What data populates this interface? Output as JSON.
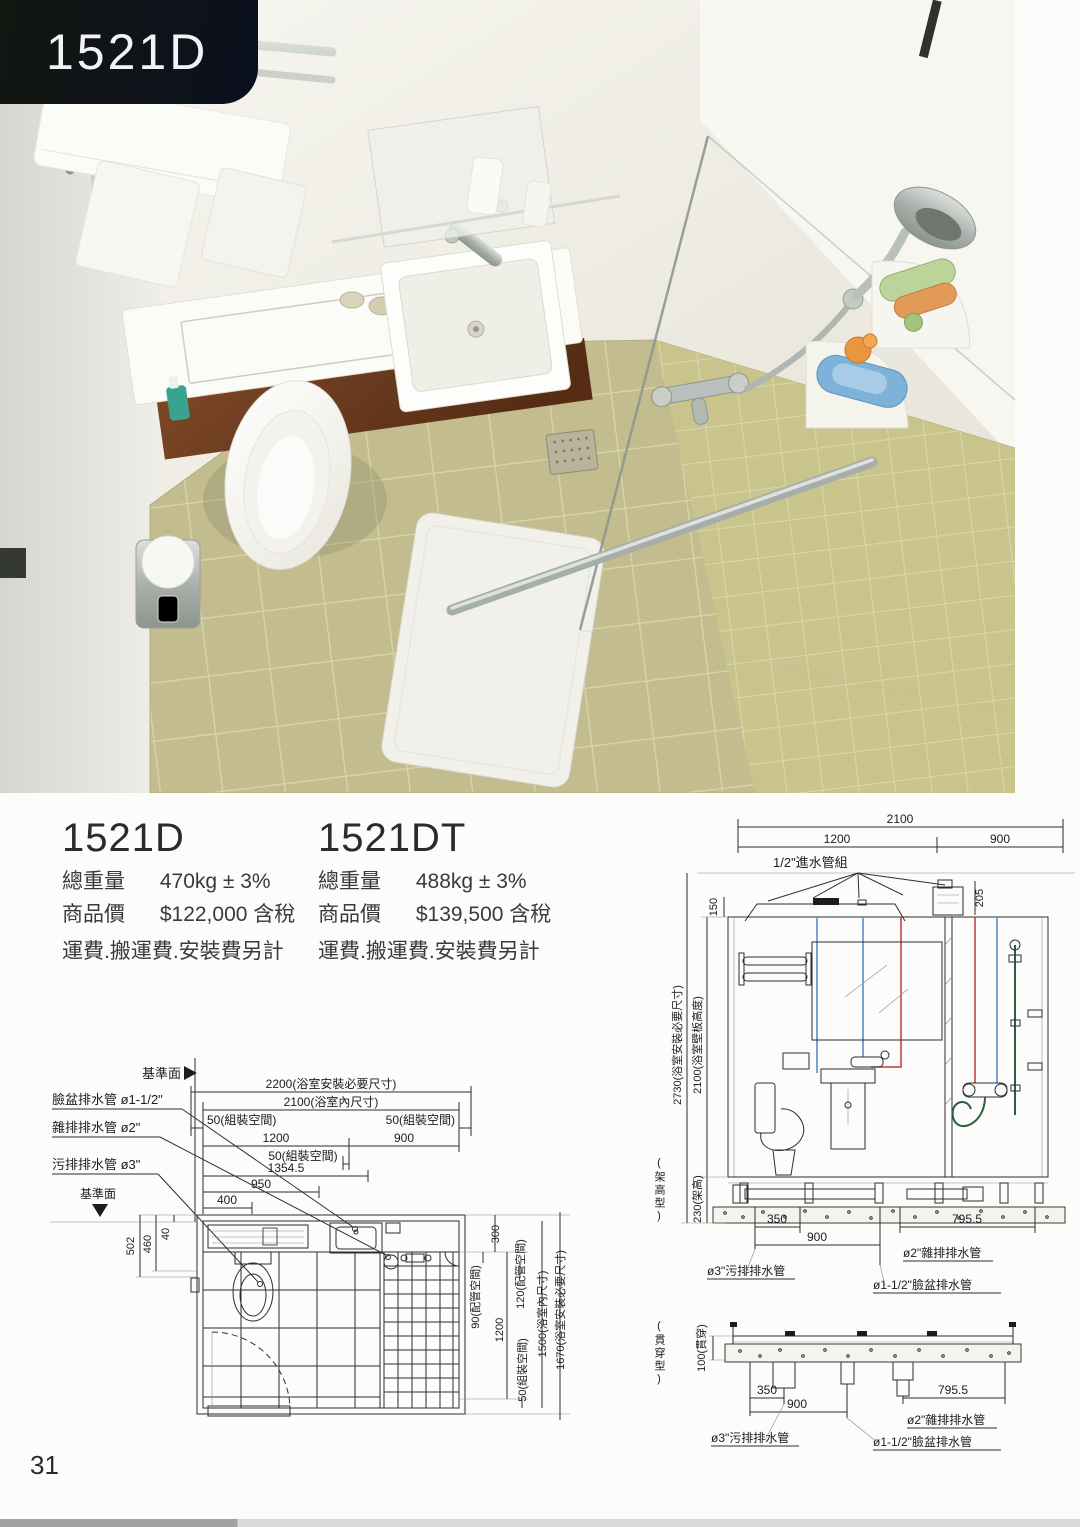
{
  "page": {
    "badge": "1521D",
    "page_number": "31"
  },
  "products": [
    {
      "model": "1521D",
      "weight_label": "總重量",
      "weight_value": "470kg ± 3%",
      "price_label": "商品價",
      "price_value": "$122,000 含稅",
      "note": "運費.搬運費.安裝費另計"
    },
    {
      "model": "1521DT",
      "weight_label": "總重量",
      "weight_value": "488kg ± 3%",
      "price_label": "商品價",
      "price_value": "$139,500 含稅",
      "note": "運費.搬運費.安裝費另計"
    }
  ],
  "plan": {
    "datum_top": "基準面",
    "datum_bottom": "基準面",
    "leaders": {
      "basin": "臉盆排水管 ø1-1/2\"",
      "misc": "雜排排水管 ø2\"",
      "soil": "污排排水管 ø3\""
    },
    "h_dims": {
      "overall": "2200(浴室安裝必要尺寸)",
      "inner": "2100(浴室內尺寸)",
      "asm_left": "50(組裝空間)",
      "asm_right": "50(組裝空間)",
      "w1200": "1200",
      "w900": "900",
      "asm_mid": "50(組裝空間)",
      "w1354": "1354.5",
      "w950": "950",
      "w400": "400"
    },
    "v_dims_left": {
      "d502": "502",
      "d460": "460",
      "d40": "40"
    },
    "v_dims_right": {
      "d300": "300",
      "d90": "90(配管空間)",
      "d120": "120(配管空間)",
      "d1200": "1200",
      "d50": "50(組裝空間)",
      "d1500": "1500(浴室內尺寸)",
      "d1670": "1670(浴室安裝必要尺寸)"
    }
  },
  "elevation": {
    "h_dims": {
      "overall": "2100",
      "left": "1200",
      "right": "900"
    },
    "inlet_label": "1/2\"進水管組",
    "d150": "150",
    "d205": "205",
    "v_dims": {
      "d2730": "2730(浴室安裝必要尺寸)",
      "d2100": "2100(浴室壁板高度)",
      "d230": "230(架高)"
    },
    "type_label": "(架高型)",
    "bottom": {
      "d350": "350",
      "d900": "900",
      "d795": "795.5",
      "misc": "ø2\"雜排排水管",
      "soil": "ø3\"污排排水管",
      "basin": "ø1-1/2\"臉盆排水管"
    }
  },
  "section": {
    "type_label": "(貫穿型)",
    "d100": "100(貫穿)",
    "d350": "350",
    "d900": "900",
    "d795": "795.5",
    "misc": "ø2\"雜排排水管",
    "soil": "ø3\"污排排水管",
    "basin": "ø1-1/2\"臉盆排水管"
  }
}
